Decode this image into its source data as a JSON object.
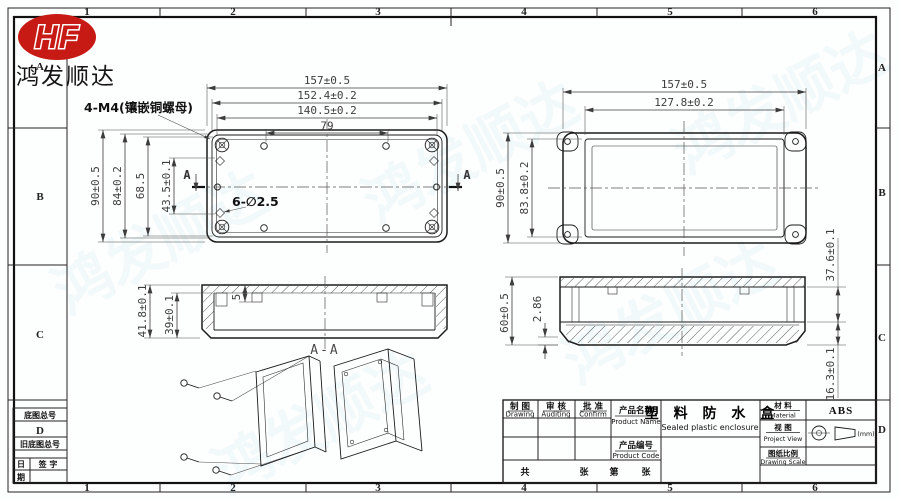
{
  "company": {
    "logo_text": "HF",
    "name": "鸿发顺达"
  },
  "border": {
    "top": [
      "1",
      "2",
      "3",
      "4",
      "5",
      "6"
    ],
    "bottom": [
      "1",
      "2",
      "3",
      "4",
      "5",
      "6"
    ],
    "left": [
      "A",
      "B",
      "C",
      "D"
    ],
    "right": [
      "A",
      "B",
      "C",
      "D"
    ]
  },
  "corner_table": {
    "base_no": "底图总号",
    "old_base_no": "旧底图总号",
    "date_top": "日",
    "date_bottom": "期",
    "signature": "签 字"
  },
  "views": {
    "top_view": {
      "w157": "157±0.5",
      "w152": "152.4±0.2",
      "w140": "140.5±0.2",
      "w79": "79",
      "h90": "90±0.5",
      "h84": "84±0.2",
      "h68": "68.5",
      "h43": "43.5±0.1",
      "note_inserts": "4-M4(镶嵌铜螺母)",
      "note_holes": "6-∅2.5",
      "section_label": "A"
    },
    "front_view": {
      "w157": "157±0.5",
      "w127": "127.8±0.2",
      "h90": "90±0.5",
      "h83": "83.8±0.2"
    },
    "section_view": {
      "label": "A-A",
      "h41": "41.8±0.1",
      "h39": "39±0.1",
      "d5": "5"
    },
    "side_view": {
      "h60": "60±0.5",
      "d286": "2.86",
      "d376": "37.6±0.1",
      "d163": "16.3±0.1"
    }
  },
  "title_block": {
    "drawing_cn": "制 图",
    "drawing_en": "Drawing",
    "auditing_cn": "审 核",
    "auditing_en": "Auditing",
    "confirm_cn": "批 准",
    "confirm_en": "Confirm",
    "product_name_cn": "产品名称",
    "product_name_en": "Product Name",
    "product_name_value_cn": "塑 料 防 水 盒",
    "product_name_value_en": "Sealed plastic enclosure",
    "product_code_cn": "产品编号",
    "product_code_en": "Product Code",
    "material_cn": "材 料",
    "material_en": "Material",
    "material_value": "ABS",
    "view_cn": "视 图",
    "view_en": "Project View",
    "unit": "(mm)",
    "scale_cn": "图纸比例",
    "scale_en": "Drawing Scale",
    "sheet_total_label": "共",
    "sheet_unit1": "张",
    "sheet_no_label": "第",
    "sheet_unit2": "张"
  }
}
